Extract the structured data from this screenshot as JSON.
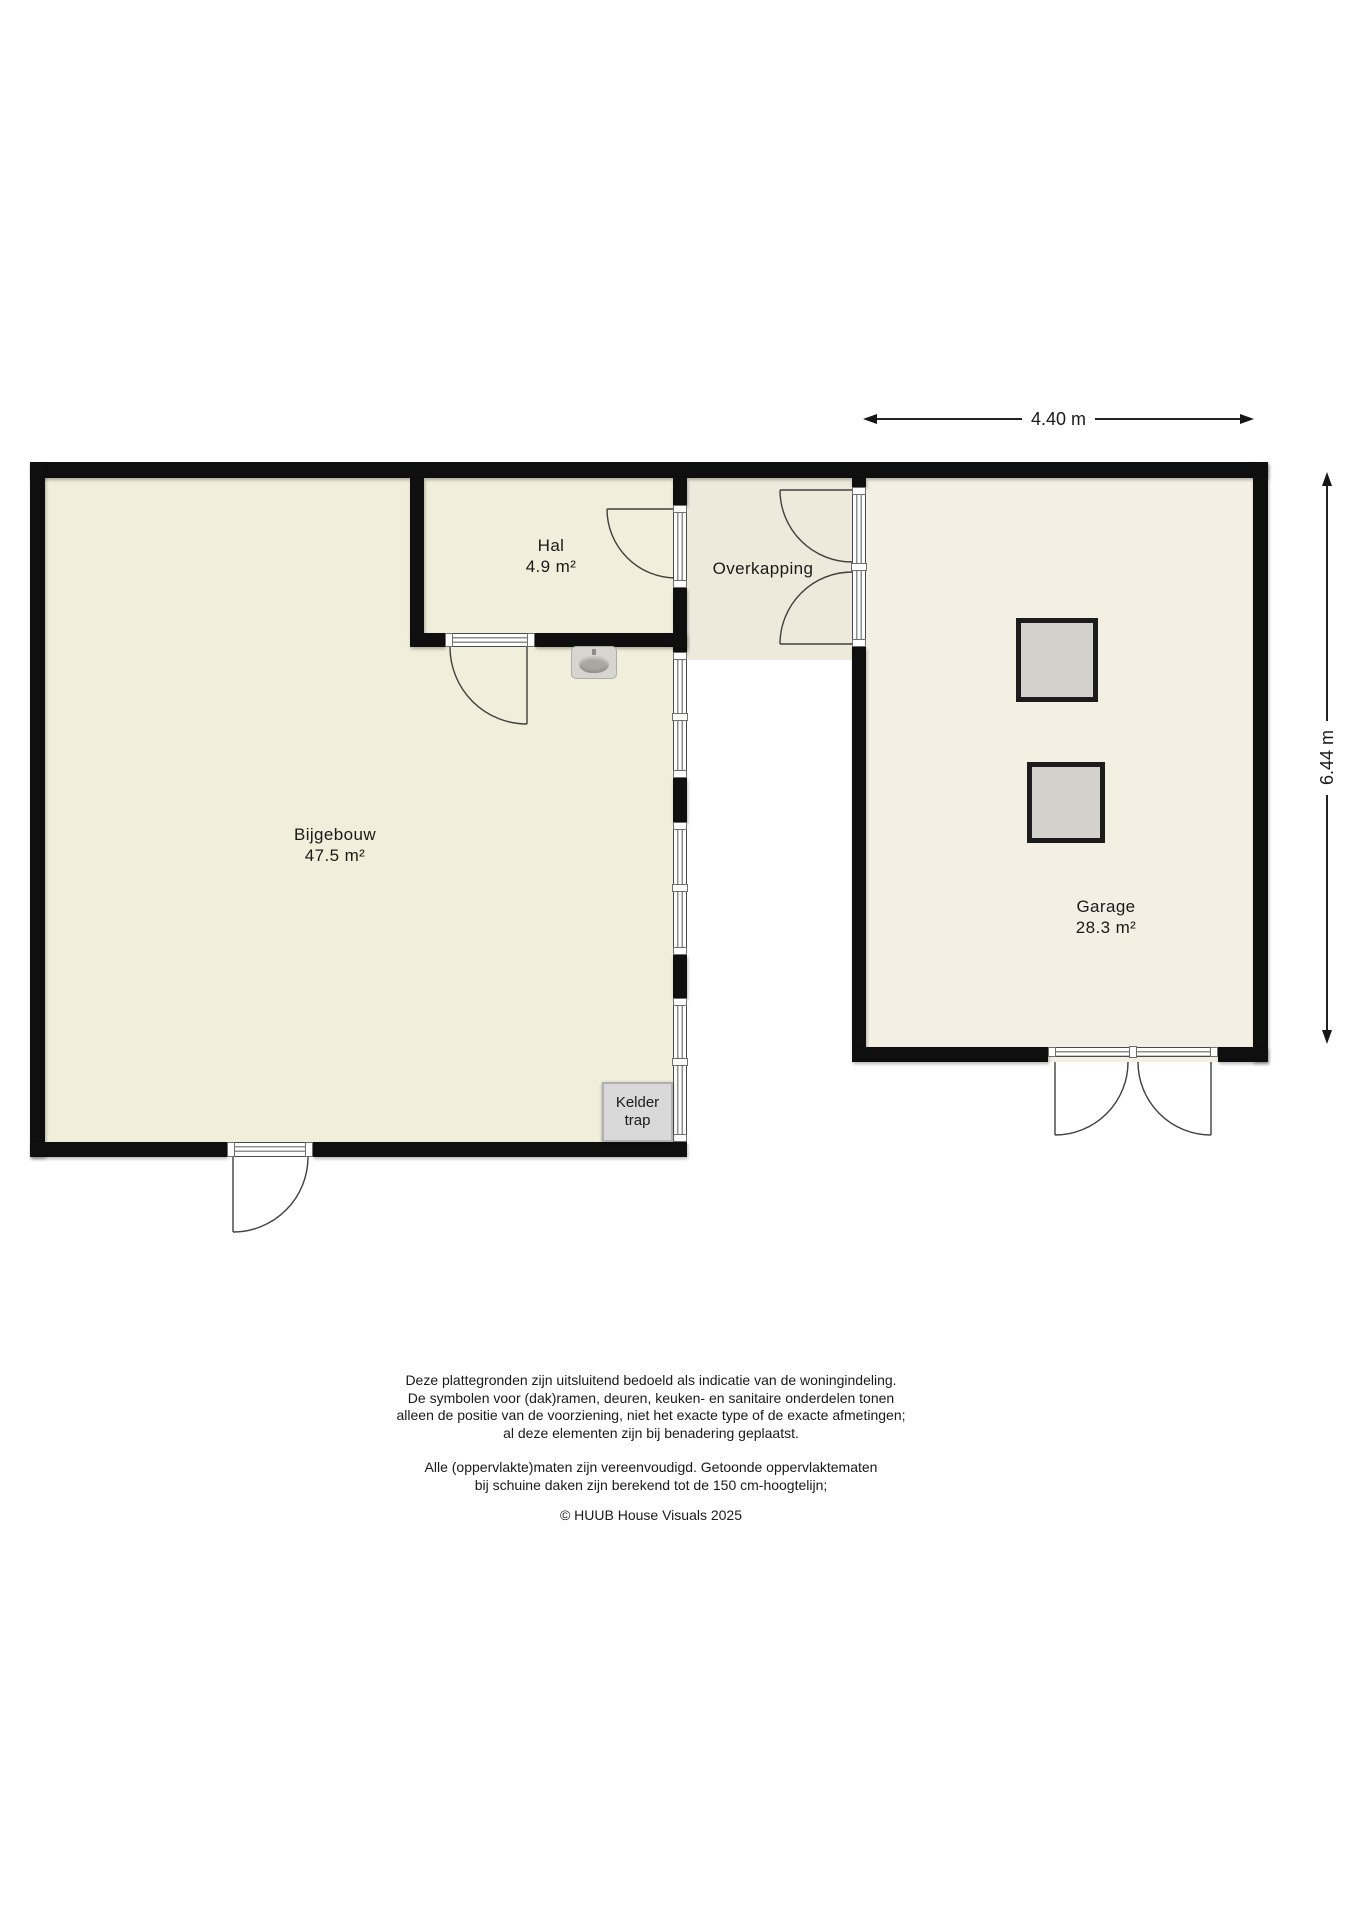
{
  "plan": {
    "rooms": {
      "bijgebouw": {
        "name": "Bijgebouw",
        "area": "47.5 m²"
      },
      "hal": {
        "name": "Hal",
        "area": "4.9 m²"
      },
      "overkapping": {
        "name": "Overkapping"
      },
      "garage": {
        "name": "Garage",
        "area": "28.3 m²"
      }
    },
    "stair_box": {
      "line1": "Kelder",
      "line2": "trap"
    }
  },
  "dimensions": {
    "garage_width": "4.40 m",
    "garage_height": "6.44 m"
  },
  "footer": {
    "disclaimer1": [
      "Deze plattegronden zijn uitsluitend bedoeld als indicatie van de woningindeling.",
      "De symbolen voor (dak)ramen, deuren, keuken- en sanitaire onderdelen tonen",
      "alleen de positie van de voorziening, niet het exacte type of de exacte afmetingen;",
      "al deze elementen zijn bij benadering geplaatst."
    ],
    "disclaimer2": [
      "Alle (oppervlakte)maten zijn vereenvoudigd. Getoonde oppervlaktematen",
      "bij schuine daken zijn berekend tot de 150 cm-hoogtelijn;"
    ],
    "copyright": "© HUUB House Visuals 2025"
  },
  "icons": {
    "sink": "sink-icon"
  },
  "colors": {
    "wall": "#0f0f0f",
    "floorMain": "#f1eedb",
    "floorOverkapping": "#edeadb",
    "floorGarage": "#f3f0e3",
    "objectGray": "#d2d1cb",
    "boxGray": "#d9d9d9",
    "text": "#1a1a1a"
  }
}
